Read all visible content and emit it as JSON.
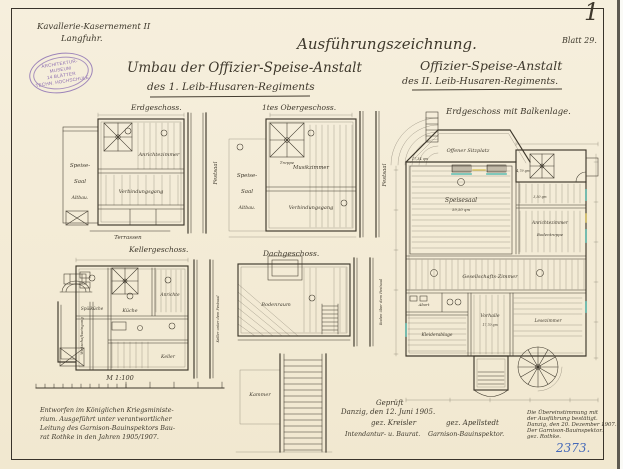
{
  "header": {
    "location_line1": "Kavallerie-Kasernement II",
    "location_line2": "Langfuhr.",
    "document_type": "Ausführungszeichnung.",
    "sheet_number": "Blatt 29.",
    "corner_mark": "1",
    "left_title_line1": "Umbau der Offizier-Speise-Anstalt",
    "left_title_line2": "des 1. Leib-Husaren-Regiments",
    "right_title_line1": "Offizier-Speise-Anstalt",
    "right_title_line2": "des II. Leib-Husaren-Regiments."
  },
  "stamp": {
    "line1": "ARCHITEKTUR-MUSEUM",
    "line2": "14 BLÄTTER",
    "line3": "TECHN. HOCHSCHULE"
  },
  "plans": {
    "erdgeschoss": {
      "title": "Erdgeschoss.",
      "speise": "Speise-",
      "saal": "Saal",
      "altbau": "Altbau.",
      "anrichtezimmer": "Anrichtezimmer",
      "verbindungsgang": "Verbindungsgang",
      "terrassen": "Terrassen",
      "festsaal": "Festsaal"
    },
    "obergeschoss": {
      "title": "1tes Obergeschoss.",
      "speise": "Speise-",
      "saal": "Saal",
      "altbau": "Altbau.",
      "musikzimmer": "Musikzimmer",
      "verbindungsgang": "Verbindungsgang",
      "treppe": "Treppe",
      "festsaal": "Festsaal"
    },
    "kellergeschoss": {
      "title": "Kellergeschoss.",
      "spuelkueche": "Spülküche",
      "kueche": "Küche",
      "anrichte": "Anrichte",
      "keller": "Keller",
      "gang": "Wirtschaftseingang",
      "festsaal": "Keller unter dem Festsaal"
    },
    "dachgeschoss": {
      "title": "Dachgeschoss.",
      "bodenraum": "Bodenraum",
      "kammer": "Kammer",
      "festsaal": "Boden über dem Festsaal"
    },
    "hauptplan": {
      "title": "Erdgeschoss mit Balkenlage.",
      "sitzplatz": "Offener Sitzplatz",
      "sitzplatz_area": "17,34 qm",
      "speisesaal": "Speisesaal",
      "speisesaal_area": "59,50 qm",
      "aufzug_area": "3,50 qm",
      "treppe_area": "4,79 qm",
      "anrichtezimmer": "Anrichtezimmer",
      "bodentreppe": "Bodentreppe",
      "gesellschaftszimmer": "Gesellschafts-Zimmer",
      "abort": "Abort",
      "kleiderablage": "Kleiderablage",
      "vorhalle": "Vorhalle",
      "vorhalle_area": "17,70 qm",
      "lesezimmer": "Lesezimmer"
    }
  },
  "scale_label": "M 1:100",
  "notes": {
    "designed": [
      "Entworfen im Königlichen Kriegsministe-",
      "rium. Ausgeführt unter verantwortlicher",
      "Leitung des Garnison-Bauinspektors Bau-",
      "rat Rothke in den Jahren 1905/1907."
    ],
    "approval": {
      "gep": "Geprüft",
      "date": "Danzig, den 12. Juni 1905.",
      "sig1": "gez. Kreisler",
      "sig2": "gez. Apellstedt",
      "role1": "Intendantur- u. Baurat.",
      "role2": "Garnison-Bauinspektor."
    },
    "confirm": [
      "Die Übereinstimmung mit",
      "der Ausführung bestätigt.",
      "Danzig, den 20. Dezember 1907.",
      "Der Garnison-Bauinspektor.",
      "gez. Rothke."
    ],
    "inventory_number": "2373."
  }
}
